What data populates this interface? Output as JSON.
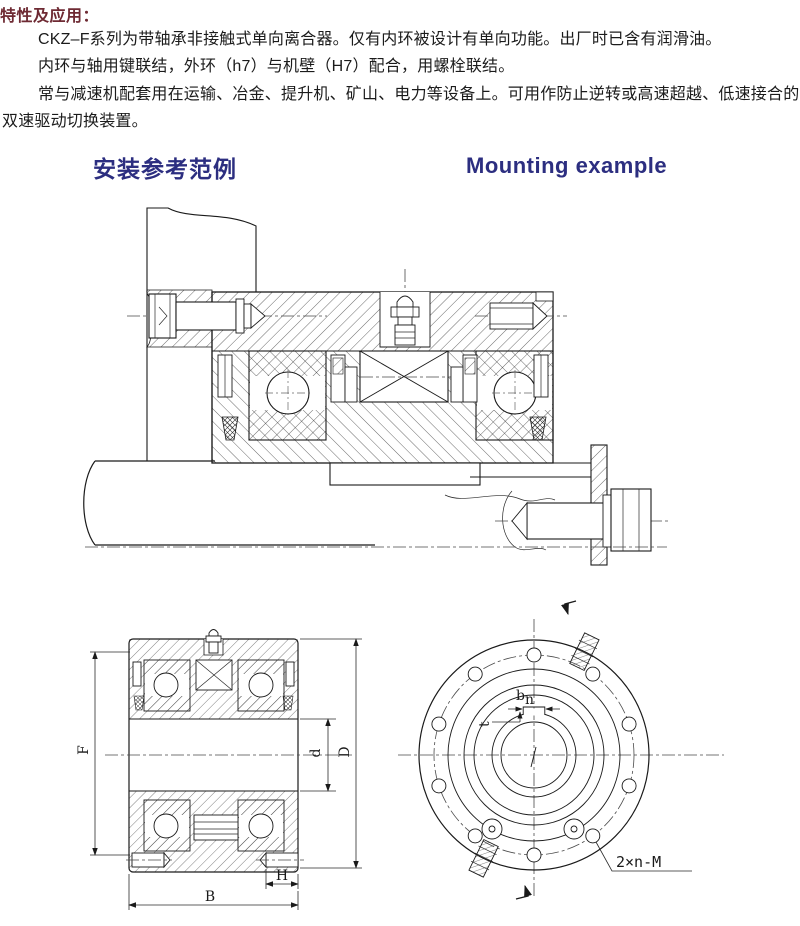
{
  "intro": {
    "title": "特性及应用：",
    "title_color": "#6e2a33",
    "lines": [
      "CKZ–F系列为带轴承非接触式单向离合器。仅有内环被设计有单向功能。出厂时已含有润滑油。",
      "内环与轴用键联结，外环（h7）与机壁（H7）配合，用螺栓联结。",
      "常与减速机配套用在运输、冶金、提升机、矿山、电力等设备上。可用作防止逆转或高速超越、低速接合的",
      "双速驱动切换装置。"
    ]
  },
  "section": {
    "heading_zh": "安装参考范例",
    "heading_en": "Mounting example",
    "heading_color": "#2c2e80"
  },
  "figures": {
    "cross_section": {
      "labels": {
        "F": "F",
        "d": "d",
        "D": "D",
        "H": "H",
        "B": "B"
      }
    },
    "front_view": {
      "keyway_width": "b",
      "keyway_width_sub": "n",
      "keyway_depth": "t",
      "bolt_spec": "2×n-M"
    }
  }
}
